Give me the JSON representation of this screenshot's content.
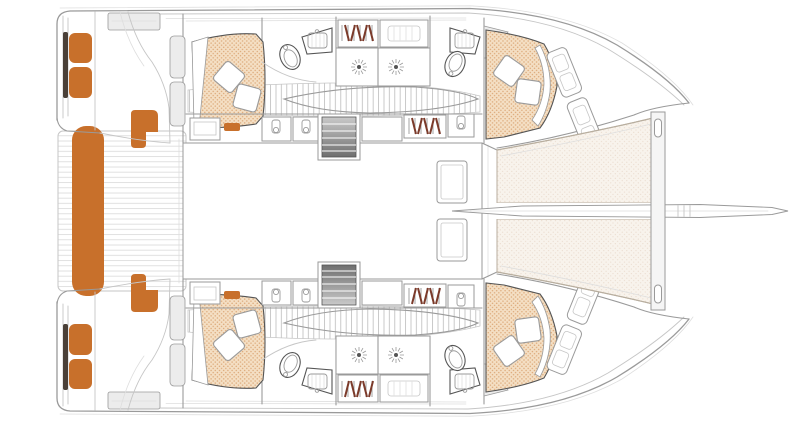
{
  "figure": {
    "kind": "catamaran-accommodation-floor-plan-top-view",
    "orientation": "bow-right",
    "text_labels": []
  },
  "colors": {
    "background": "#ffffff",
    "accent_orange": "#c8702b",
    "seat_frame_dark": "#4a4038",
    "bed_base": "#f4dfc4",
    "bed_dot": "#dca878",
    "tramp_base": "#f8f3ec",
    "tramp_dot": "#e6d5c6",
    "tramp_edge": "#b8ae9f",
    "hanger_rust": "#7b3a2a",
    "line_dark": "#555555",
    "line_mid": "#9a9a9a",
    "line_light": "#c6c6c6",
    "line_faint": "#dedede",
    "plank_line": "#d8d8d8",
    "slat_line": "#bcbcbc",
    "stair_light": "#c9c9c9",
    "stair_dark": "#6e6e6e",
    "panel_gray": "#ececec",
    "beam_gray": "#f5f5f5"
  },
  "legend": {
    "symbols": [
      "transom-bench-cushion",
      "helm-seat-cushion",
      "corner-seat-cushion",
      "cockpit-teak-deck",
      "saloon",
      "companionway-stairs",
      "double-berth",
      "pillow",
      "toilet",
      "washbasin",
      "vanity-cabinet",
      "shower-head",
      "wardrobe-hangers",
      "storage-locker",
      "hull-corridor",
      "forward-cabin-berth",
      "bow-locker",
      "foredeck-door",
      "trampoline-net",
      "forward-crossbeam",
      "bowsprit"
    ]
  }
}
